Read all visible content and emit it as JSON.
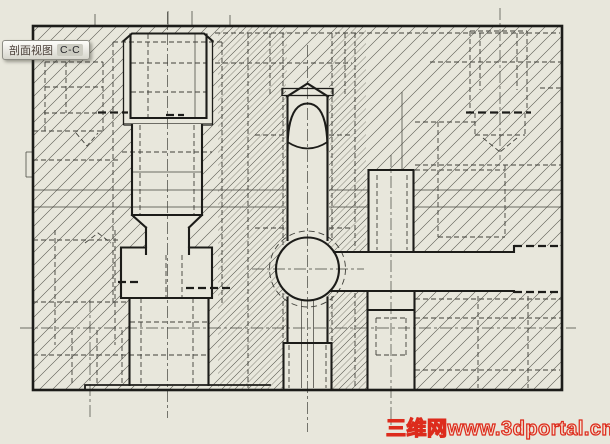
{
  "section_label": {
    "name": "剖面视图",
    "ref": "C-C"
  },
  "watermark": {
    "text": "三维网www.3dportal.cn"
  },
  "colors": {
    "bg": "#e8e7dc",
    "line": "#1c1c19",
    "thin": "#44443e",
    "hidden": "#3f3f39",
    "hatch": "#56564e",
    "label-text": "#4a3f38",
    "wm": "#dd2b1c"
  },
  "drawing": {
    "view_type": "section-view",
    "view_ref": "C-C"
  }
}
